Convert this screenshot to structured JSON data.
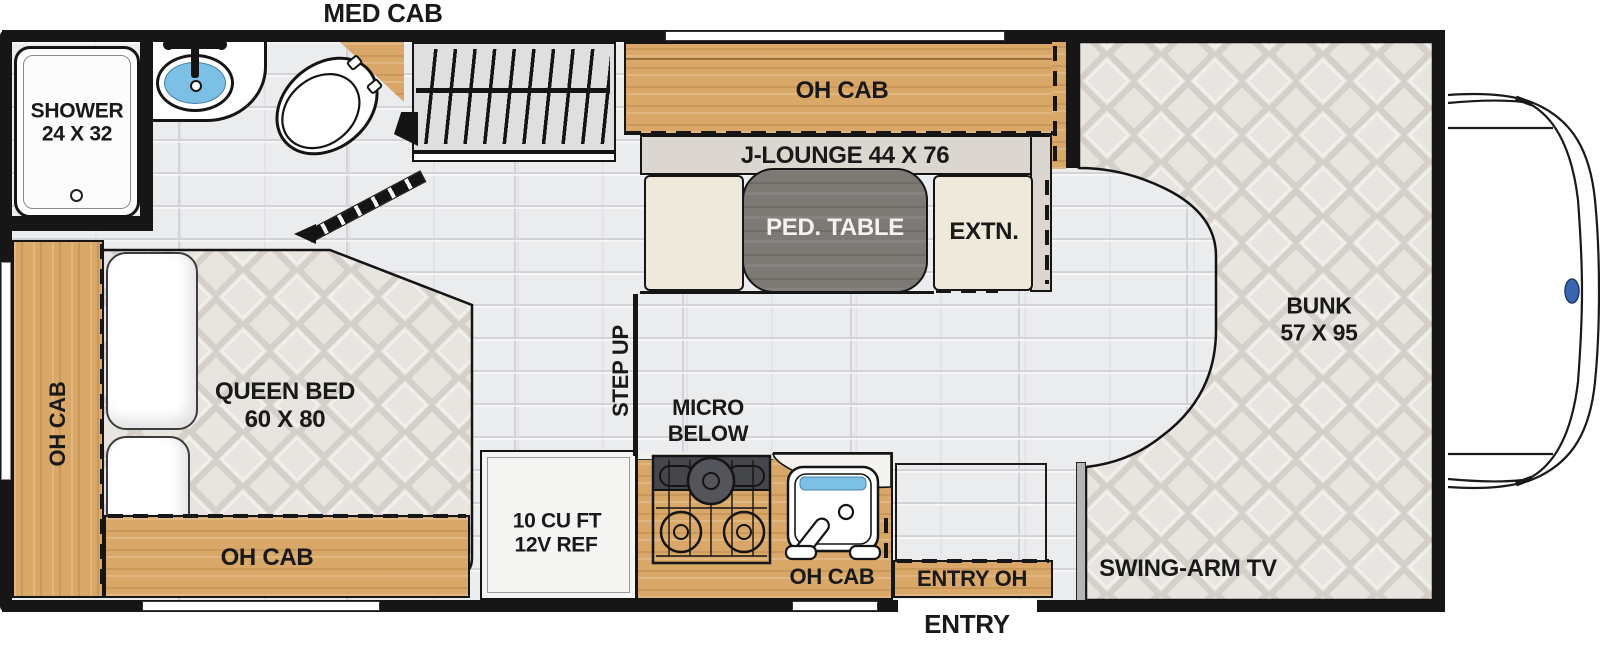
{
  "labels": {
    "med_cab": "MED CAB",
    "shower_l1": "SHOWER",
    "shower_l2": "24 X 32",
    "dinette_oh_cab": "OH CAB",
    "j_lounge": "J-LOUNGE 44 X 76",
    "ped_table": "PED. TABLE",
    "extn": "EXTN.",
    "bunk_l1": "BUNK",
    "bunk_l2": "57 X 95",
    "swing_arm_tv": "SWING-ARM TV",
    "queen_l1": "QUEEN BED",
    "queen_l2": "60 X 80",
    "oh_cab_left": "OH CAB",
    "oh_cab_bed_bottom": "OH CAB",
    "fridge_l1": "10 CU FT",
    "fridge_l2": "12V REF",
    "micro_l1": "MICRO",
    "micro_l2": "BELOW",
    "step_up": "STEP UP",
    "oh_cab_galley": "OH CAB",
    "entry_oh": "ENTRY OH",
    "entry": "ENTRY"
  },
  "colors": {
    "wall": "#161616",
    "wood": "#d9a767",
    "wood_dark": "#b98a4e",
    "tile": "#ebecee",
    "tile_line": "#d2d3d7",
    "mattress": "#e8e5e0",
    "quilt_line": "#d4d0c9",
    "table": "#7d7975",
    "seat": "#efe9dc",
    "lounge": "#dbd7d0",
    "wardrobe": "#dfdfdf",
    "water": "#7cc0e6",
    "divider": "#b5b5b5"
  }
}
